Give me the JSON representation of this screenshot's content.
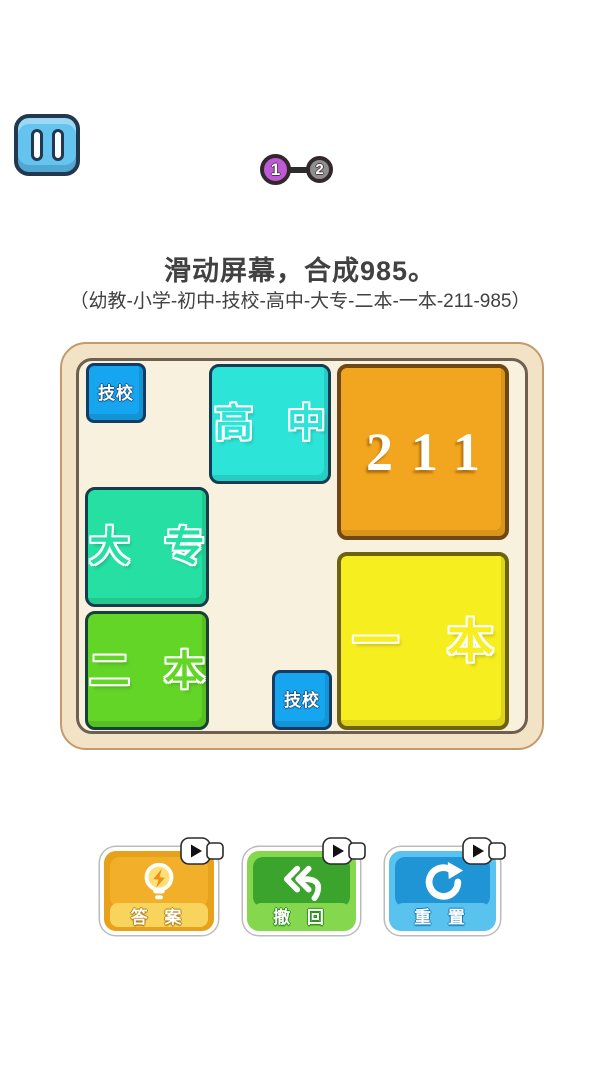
{
  "screen": {
    "background": "#ffffff"
  },
  "top_bar": {
    "pause": {
      "icon": "pause-icon",
      "color": "#64c3ef",
      "outline": "#22384e"
    }
  },
  "progress": {
    "connector_color": "#2d2d2d",
    "steps": [
      {
        "label": "1",
        "color": "#bf5ad6",
        "state": "current"
      },
      {
        "label": "2",
        "color": "#8f8f8f",
        "state": "upcoming"
      }
    ]
  },
  "instructions": {
    "title": "滑动屏幕，合成985。",
    "sequence": "（幼教-小学-初中-技校-高中-大专-二本-一本-211-985）"
  },
  "board": {
    "frame_fill": "#f3e3c6",
    "frame_outer_line": "#c49a6c",
    "frame_inner_line": "#6e5f50",
    "surface_fill": "#f8f1dd",
    "blocks": [
      {
        "id": "jixiao-1",
        "label": "技校",
        "size": "1x1",
        "fill": "#16a5ef",
        "border": "#123c63",
        "grid": "col 1, row 1"
      },
      {
        "id": "gaozhong",
        "label": "高 中",
        "size": "2x2",
        "fill": "#2ce5d8",
        "border": "#143c55",
        "grid": "cols 3-4, rows 1-2"
      },
      {
        "id": "211",
        "label": "211",
        "size": "3x3",
        "fill": "#f2a51e",
        "border": "#6e4712",
        "grid": "cols 5-7, rows 1-3"
      },
      {
        "id": "dazhuan",
        "label": "大 专",
        "size": "2x2",
        "fill": "#25e0a2",
        "border": "#143c4a",
        "grid": "cols 1-2, rows 3-4"
      },
      {
        "id": "erben",
        "label": "二 本",
        "size": "2x2",
        "fill": "#62d527",
        "border": "#174038",
        "grid": "cols 1-2, rows 5-6"
      },
      {
        "id": "yiben",
        "label": "一 本",
        "size": "3x3",
        "fill": "#f6ee1e",
        "border": "#6e6210",
        "grid": "cols 5-7, rows 4-6"
      },
      {
        "id": "jixiao-2",
        "label": "技校",
        "size": "1x1",
        "fill": "#16a5ef",
        "border": "#123c63",
        "grid": "col 4, row 6"
      }
    ]
  },
  "actions": [
    {
      "id": "answer",
      "label": "答 案",
      "icon": "lightbulb-icon",
      "color": "#e8a11a",
      "has_ad_badge": true
    },
    {
      "id": "undo",
      "label": "撤 回",
      "icon": "undo-icon",
      "color": "#3aa42c",
      "has_ad_badge": true
    },
    {
      "id": "reset",
      "label": "重 置",
      "icon": "refresh-icon",
      "color": "#2095d6",
      "has_ad_badge": true
    }
  ]
}
